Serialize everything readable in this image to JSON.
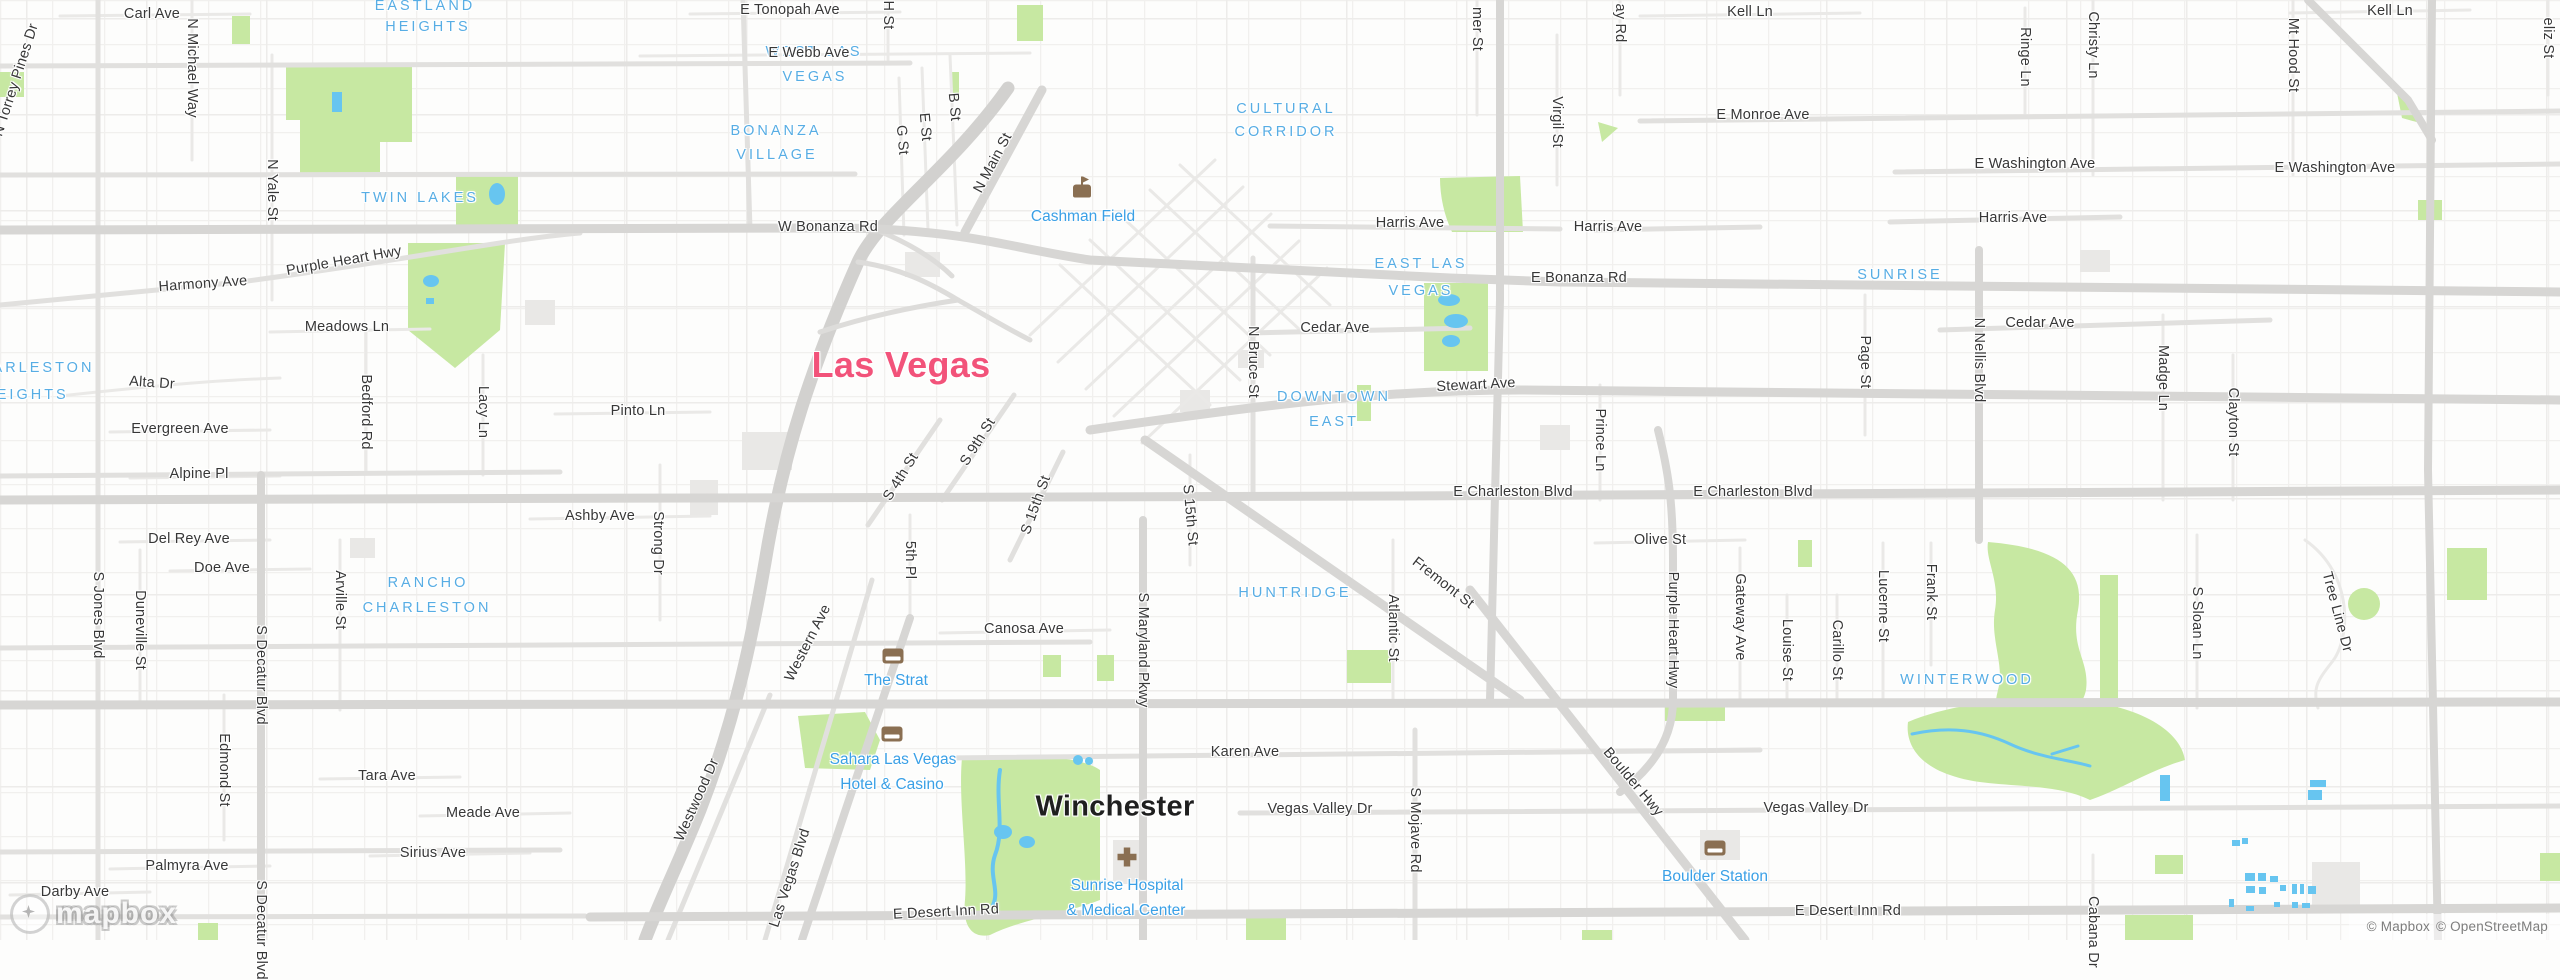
{
  "map": {
    "colors": {
      "city_major": "#f2537a",
      "city": "#1f1f1f",
      "neighborhood": "#57ade4",
      "poi": "#3aa0e6",
      "park": "#c7e8a2",
      "water": "#67c5f0",
      "road_major": "#d7d6d4",
      "road_minor": "#eae9e7",
      "poi_icon": "#8a6f52"
    },
    "attribution": {
      "mapbox": "© Mapbox",
      "osm": "© OpenStreetMap"
    },
    "logo": {
      "text": "mapbox"
    },
    "icons": [
      {
        "k": "stadium",
        "x": 1082,
        "y": 191
      },
      {
        "k": "lodging",
        "x": 893,
        "y": 656
      },
      {
        "k": "lodging",
        "x": 892,
        "y": 734
      },
      {
        "k": "hospital",
        "x": 1127,
        "y": 857
      },
      {
        "k": "lodging",
        "x": 1715,
        "y": 848
      }
    ],
    "labels": [
      {
        "t": "Las Vegas",
        "x": 901,
        "y": 365,
        "c": "cm"
      },
      {
        "t": "Winchester",
        "x": 1115,
        "y": 807,
        "c": "ci"
      },
      {
        "t": "EASTLAND",
        "x": 425,
        "y": 6,
        "c": "nb"
      },
      {
        "t": "HEIGHTS",
        "x": 428,
        "y": 27,
        "c": "nb"
      },
      {
        "t": "WEST LAS",
        "x": 814,
        "y": 52,
        "c": "nb"
      },
      {
        "t": "VEGAS",
        "x": 815,
        "y": 77,
        "c": "nb"
      },
      {
        "t": "BONANZA",
        "x": 776,
        "y": 131,
        "c": "nb"
      },
      {
        "t": "VILLAGE",
        "x": 777,
        "y": 155,
        "c": "nb"
      },
      {
        "t": "TWIN LAKES",
        "x": 420,
        "y": 198,
        "c": "nb"
      },
      {
        "t": "CULTURAL",
        "x": 1286,
        "y": 109,
        "c": "nb"
      },
      {
        "t": "CORRIDOR",
        "x": 1286,
        "y": 132,
        "c": "nb"
      },
      {
        "t": "EAST LAS",
        "x": 1421,
        "y": 264,
        "c": "nb"
      },
      {
        "t": "VEGAS",
        "x": 1421,
        "y": 291,
        "c": "nb"
      },
      {
        "t": "SUNRISE",
        "x": 1900,
        "y": 275,
        "c": "nb"
      },
      {
        "t": "DOWNTOWN",
        "x": 1334,
        "y": 397,
        "c": "nb"
      },
      {
        "t": "EAST",
        "x": 1334,
        "y": 422,
        "c": "nb"
      },
      {
        "t": "CHARLESTON",
        "x": 30,
        "y": 368,
        "c": "nb"
      },
      {
        "t": "HEIGHTS",
        "x": 26,
        "y": 395,
        "c": "nb"
      },
      {
        "t": "RANCHO",
        "x": 428,
        "y": 583,
        "c": "nb"
      },
      {
        "t": "CHARLESTON",
        "x": 427,
        "y": 608,
        "c": "nb"
      },
      {
        "t": "HUNTRIDGE",
        "x": 1295,
        "y": 593,
        "c": "nb"
      },
      {
        "t": "WINTERWOOD",
        "x": 1967,
        "y": 680,
        "c": "nb"
      },
      {
        "t": "Cashman Field",
        "x": 1083,
        "y": 217,
        "c": "poi"
      },
      {
        "t": "The Strat",
        "x": 896,
        "y": 681,
        "c": "poi"
      },
      {
        "t": "Sahara Las Vegas",
        "x": 893,
        "y": 760,
        "c": "poi"
      },
      {
        "t": "Hotel & Casino",
        "x": 892,
        "y": 785,
        "c": "poi"
      },
      {
        "t": "Sunrise Hospital",
        "x": 1127,
        "y": 886,
        "c": "poi"
      },
      {
        "t": "& Medical Center",
        "x": 1126,
        "y": 911,
        "c": "poi"
      },
      {
        "t": "Boulder Station",
        "x": 1715,
        "y": 877,
        "c": "poi"
      },
      {
        "t": "Carl Ave",
        "x": 152,
        "y": 14,
        "c": "st"
      },
      {
        "t": "E Tonopah Ave",
        "x": 790,
        "y": 10,
        "c": "st"
      },
      {
        "t": "E Webb Ave",
        "x": 809,
        "y": 53,
        "c": "st"
      },
      {
        "t": "Kell Ln",
        "x": 1750,
        "y": 12,
        "c": "st"
      },
      {
        "t": "Kell Ln",
        "x": 2390,
        "y": 11,
        "c": "st"
      },
      {
        "t": "E Monroe Ave",
        "x": 1763,
        "y": 115,
        "c": "st"
      },
      {
        "t": "E Washington Ave",
        "x": 2035,
        "y": 164,
        "c": "st"
      },
      {
        "t": "E Washington Ave",
        "x": 2335,
        "y": 168,
        "c": "st"
      },
      {
        "t": "Harris Ave",
        "x": 1410,
        "y": 223,
        "c": "st"
      },
      {
        "t": "Harris Ave",
        "x": 1608,
        "y": 227,
        "c": "st"
      },
      {
        "t": "Harris Ave",
        "x": 2013,
        "y": 218,
        "c": "st"
      },
      {
        "t": "W Bonanza Rd",
        "x": 828,
        "y": 227,
        "c": "st"
      },
      {
        "t": "E Bonanza Rd",
        "x": 1579,
        "y": 278,
        "c": "st"
      },
      {
        "t": "Harmony Ave",
        "x": 203,
        "y": 284,
        "c": "st",
        "r": -4
      },
      {
        "t": "Purple Heart Hwy",
        "x": 344,
        "y": 261,
        "c": "st",
        "r": -10
      },
      {
        "t": "Meadows Ln",
        "x": 347,
        "y": 327,
        "c": "st"
      },
      {
        "t": "Alta Dr",
        "x": 152,
        "y": 383,
        "c": "st",
        "r": 4
      },
      {
        "t": "Evergreen Ave",
        "x": 180,
        "y": 429,
        "c": "st"
      },
      {
        "t": "Alpine Pl",
        "x": 199,
        "y": 474,
        "c": "st"
      },
      {
        "t": "Del Rey Ave",
        "x": 189,
        "y": 539,
        "c": "st"
      },
      {
        "t": "Doe Ave",
        "x": 222,
        "y": 568,
        "c": "st"
      },
      {
        "t": "Pinto Ln",
        "x": 638,
        "y": 411,
        "c": "st"
      },
      {
        "t": "Ashby Ave",
        "x": 600,
        "y": 516,
        "c": "st"
      },
      {
        "t": "Cedar Ave",
        "x": 1335,
        "y": 328,
        "c": "st"
      },
      {
        "t": "Cedar Ave",
        "x": 2040,
        "y": 323,
        "c": "st"
      },
      {
        "t": "Stewart Ave",
        "x": 1476,
        "y": 385,
        "c": "st",
        "r": -3
      },
      {
        "t": "E Charleston Blvd",
        "x": 1513,
        "y": 492,
        "c": "st"
      },
      {
        "t": "E Charleston Blvd",
        "x": 1753,
        "y": 492,
        "c": "st"
      },
      {
        "t": "Olive St",
        "x": 1660,
        "y": 540,
        "c": "st"
      },
      {
        "t": "Canosa Ave",
        "x": 1024,
        "y": 629,
        "c": "st"
      },
      {
        "t": "Karen Ave",
        "x": 1245,
        "y": 752,
        "c": "st"
      },
      {
        "t": "Vegas Valley Dr",
        "x": 1320,
        "y": 809,
        "c": "st"
      },
      {
        "t": "Vegas Valley Dr",
        "x": 1816,
        "y": 808,
        "c": "st"
      },
      {
        "t": "E Desert Inn Rd",
        "x": 946,
        "y": 912,
        "c": "st",
        "r": -3
      },
      {
        "t": "E Desert Inn Rd",
        "x": 1848,
        "y": 911,
        "c": "st"
      },
      {
        "t": "Tara Ave",
        "x": 387,
        "y": 776,
        "c": "st"
      },
      {
        "t": "Meade Ave",
        "x": 483,
        "y": 813,
        "c": "st"
      },
      {
        "t": "Sirius Ave",
        "x": 433,
        "y": 853,
        "c": "st"
      },
      {
        "t": "Palmyra Ave",
        "x": 187,
        "y": 866,
        "c": "st"
      },
      {
        "t": "Darby Ave",
        "x": 75,
        "y": 892,
        "c": "st"
      },
      {
        "t": "N Torrey Pines Dr",
        "x": 16,
        "y": 80,
        "c": "st",
        "r": -72
      },
      {
        "t": "N Michael Way",
        "x": 192,
        "y": 68,
        "c": "st",
        "r": 90
      },
      {
        "t": "N Yale St",
        "x": 272,
        "y": 190,
        "c": "st",
        "r": 90
      },
      {
        "t": "S Jones Blvd",
        "x": 98,
        "y": 615,
        "c": "st",
        "r": 90
      },
      {
        "t": "Duneville St",
        "x": 140,
        "y": 630,
        "c": "st",
        "r": 90
      },
      {
        "t": "S Decatur Blvd",
        "x": 261,
        "y": 675,
        "c": "st",
        "r": 90
      },
      {
        "t": "S Decatur Blvd",
        "x": 261,
        "y": 930,
        "c": "st",
        "r": 90
      },
      {
        "t": "Arville St",
        "x": 340,
        "y": 600,
        "c": "st",
        "r": 90
      },
      {
        "t": "Edmond St",
        "x": 224,
        "y": 770,
        "c": "st",
        "r": 90
      },
      {
        "t": "Strong Dr",
        "x": 658,
        "y": 543,
        "c": "st",
        "r": 90
      },
      {
        "t": "Lacy Ln",
        "x": 483,
        "y": 412,
        "c": "st",
        "r": 90
      },
      {
        "t": "Bedford Rd",
        "x": 366,
        "y": 412,
        "c": "st",
        "r": 90
      },
      {
        "t": "5th Pl",
        "x": 910,
        "y": 560,
        "c": "st",
        "r": 90
      },
      {
        "t": "S Maryland Pkwy",
        "x": 1143,
        "y": 650,
        "c": "st",
        "r": 90
      },
      {
        "t": "N Bruce St",
        "x": 1253,
        "y": 362,
        "c": "st",
        "r": 90
      },
      {
        "t": "Virgil St",
        "x": 1557,
        "y": 122,
        "c": "st",
        "r": 90
      },
      {
        "t": "mer St",
        "x": 1477,
        "y": 29,
        "c": "st",
        "r": 90
      },
      {
        "t": "ay Rd",
        "x": 1620,
        "y": 23,
        "c": "st",
        "r": 90
      },
      {
        "t": "Ringe Ln",
        "x": 2025,
        "y": 57,
        "c": "st",
        "r": 90
      },
      {
        "t": "Christy Ln",
        "x": 2093,
        "y": 45,
        "c": "st",
        "r": 90
      },
      {
        "t": "Mt Hood St",
        "x": 2293,
        "y": 55,
        "c": "st",
        "r": 90
      },
      {
        "t": "eliz St",
        "x": 2548,
        "y": 38,
        "c": "st",
        "r": 90
      },
      {
        "t": "Page St",
        "x": 1865,
        "y": 362,
        "c": "st",
        "r": 90
      },
      {
        "t": "Prince Ln",
        "x": 1600,
        "y": 440,
        "c": "st",
        "r": 90
      },
      {
        "t": "Madge Ln",
        "x": 2163,
        "y": 378,
        "c": "st",
        "r": 90
      },
      {
        "t": "Clayton St",
        "x": 2233,
        "y": 422,
        "c": "st",
        "r": 90
      },
      {
        "t": "N Nellis Blvd",
        "x": 1979,
        "y": 360,
        "c": "st",
        "r": 90
      },
      {
        "t": "Gateway Ave",
        "x": 1740,
        "y": 617,
        "c": "st",
        "r": 90
      },
      {
        "t": "Louise St",
        "x": 1787,
        "y": 650,
        "c": "st",
        "r": 90
      },
      {
        "t": "Carillo St",
        "x": 1837,
        "y": 650,
        "c": "st",
        "r": 90
      },
      {
        "t": "Lucerne St",
        "x": 1883,
        "y": 606,
        "c": "st",
        "r": 90
      },
      {
        "t": "Frank St",
        "x": 1931,
        "y": 592,
        "c": "st",
        "r": 90
      },
      {
        "t": "Purple Heart Hwy",
        "x": 1673,
        "y": 630,
        "c": "st",
        "r": 90
      },
      {
        "t": "Atlantic St",
        "x": 1393,
        "y": 628,
        "c": "st",
        "r": 90
      },
      {
        "t": "S Mojave Rd",
        "x": 1415,
        "y": 830,
        "c": "st",
        "r": 90
      },
      {
        "t": "S Sloan Ln",
        "x": 2197,
        "y": 623,
        "c": "st",
        "r": 90
      },
      {
        "t": "Cabana Dr",
        "x": 2093,
        "y": 932,
        "c": "st",
        "r": 90
      },
      {
        "t": "H St",
        "x": 888,
        "y": 15,
        "c": "st",
        "r": 90
      },
      {
        "t": "B St",
        "x": 954,
        "y": 107,
        "c": "st",
        "r": 85
      },
      {
        "t": "E St",
        "x": 925,
        "y": 127,
        "c": "st",
        "r": 85
      },
      {
        "t": "G St",
        "x": 902,
        "y": 140,
        "c": "st",
        "r": 85
      },
      {
        "t": "N Main St",
        "x": 993,
        "y": 163,
        "c": "st",
        "r": -62
      },
      {
        "t": "S 4th St",
        "x": 901,
        "y": 477,
        "c": "st",
        "r": -58
      },
      {
        "t": "S 9th St",
        "x": 978,
        "y": 442,
        "c": "st",
        "r": -58
      },
      {
        "t": "S 15th St",
        "x": 1036,
        "y": 505,
        "c": "st",
        "r": -70
      },
      {
        "t": "S 15th St",
        "x": 1190,
        "y": 515,
        "c": "st",
        "r": 85
      },
      {
        "t": "Fremont St",
        "x": 1443,
        "y": 583,
        "c": "st",
        "r": 38
      },
      {
        "t": "Boulder Hwy",
        "x": 1633,
        "y": 782,
        "c": "st",
        "r": 50
      },
      {
        "t": "Western Ave",
        "x": 808,
        "y": 643,
        "c": "st",
        "r": -63
      },
      {
        "t": "Westwood Dr",
        "x": 697,
        "y": 800,
        "c": "st",
        "r": -66
      },
      {
        "t": "Las Vegas Blvd",
        "x": 790,
        "y": 878,
        "c": "st",
        "r": -72
      },
      {
        "t": "Tree Line Dr",
        "x": 2337,
        "y": 612,
        "c": "st",
        "r": 75
      }
    ]
  }
}
